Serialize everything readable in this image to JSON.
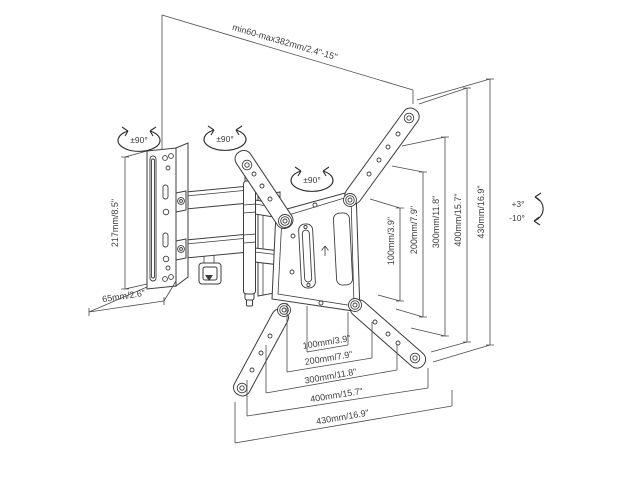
{
  "diagram": {
    "type": "technical-drawing",
    "subject": "articulating full-motion TV wall mount with dimension annotations",
    "background_color": "#ffffff",
    "line_color": "#3d3d3d",
    "labels": {
      "extension_range": "min60-max382mm/2.4\"-15\"",
      "wall_plate_height": "217mm/8.5\"",
      "folded_depth": "65mm/2.6\"",
      "swivel_wall_plate": "±90°",
      "swivel_arm_joint": "±90°",
      "swivel_tv_plate": "±90°",
      "tilt_up": "+3°",
      "tilt_down": "-10°"
    },
    "vesa_vertical_dimensions": [
      "100mm/3.9\"",
      "200mm/7.9\"",
      "300mm/11.8\"",
      "400mm/15.7\"",
      "430mm/16.9\""
    ],
    "vesa_horizontal_dimensions": [
      "100mm/3.9\"",
      "200mm/7.9\"",
      "300mm/11.8\"",
      "400mm/15.7\"",
      "430mm/16.9\""
    ]
  }
}
